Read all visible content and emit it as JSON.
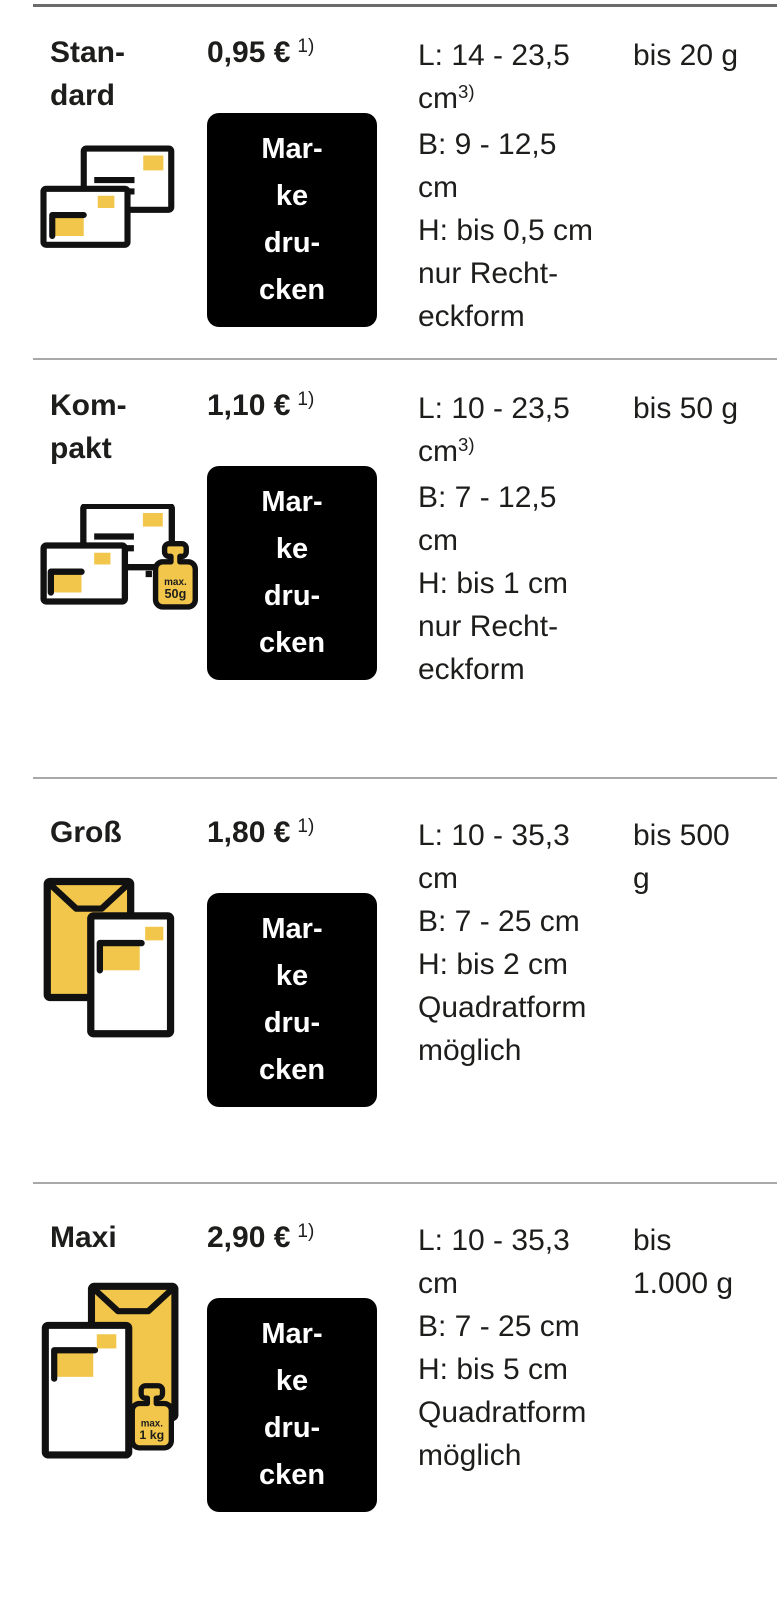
{
  "colors": {
    "brand_yellow": "#f2c64b",
    "button_black": "#000000",
    "button_text": "#ffffff",
    "body_text": "#1d1d1b",
    "divider_top": "#6b6b6b",
    "divider_row": "#a9a9a9"
  },
  "table": {
    "rows": [
      {
        "format": "Stan-\ndard",
        "icon": "two-envelopes-icon",
        "price": "0,95 €",
        "price_footnote": "1)",
        "button_label": "Mar-\nke\ndru-\ncken",
        "dimensions": "L: 14 - 23,5\ncm^{3)}\nB: 9 - 12,5\ncm\nH: bis 0,5 cm\nnur Recht-\neckform",
        "weight": "bis 20 g"
      },
      {
        "format": "Kom-\npakt",
        "icon": "two-envelopes-weight-50g-icon",
        "icon_weight_line1": "max.",
        "icon_weight_line2": "50g",
        "price": "1,10 €",
        "price_footnote": "1)",
        "button_label": "Mar-\nke\ndru-\ncken",
        "dimensions": "L: 10 - 23,5\ncm^{3)}\nB: 7 - 12,5\ncm\nH: bis 1 cm\nnur Recht-\neckform",
        "weight": "bis 50 g"
      },
      {
        "format": "Groß",
        "icon": "large-envelope-letter-icon",
        "price": "1,80 €",
        "price_footnote": "1)",
        "button_label": "Mar-\nke\ndru-\ncken",
        "dimensions": "L: 10 - 35,3\ncm\nB: 7 - 25 cm\nH: bis 2 cm\nQuadratform\nmöglich",
        "weight": "bis 500\ng"
      },
      {
        "format": "Maxi",
        "icon": "large-envelope-letter-weight-1kg-icon",
        "icon_weight_line1": "max.",
        "icon_weight_line2": "1 kg",
        "price": "2,90 €",
        "price_footnote": "1)",
        "button_label": "Mar-\nke\ndru-\ncken",
        "dimensions": "L: 10 - 35,3\ncm\nB: 7 - 25 cm\nH: bis 5 cm\nQuadratform\nmöglich",
        "weight": "bis\n1.000 g"
      }
    ]
  }
}
